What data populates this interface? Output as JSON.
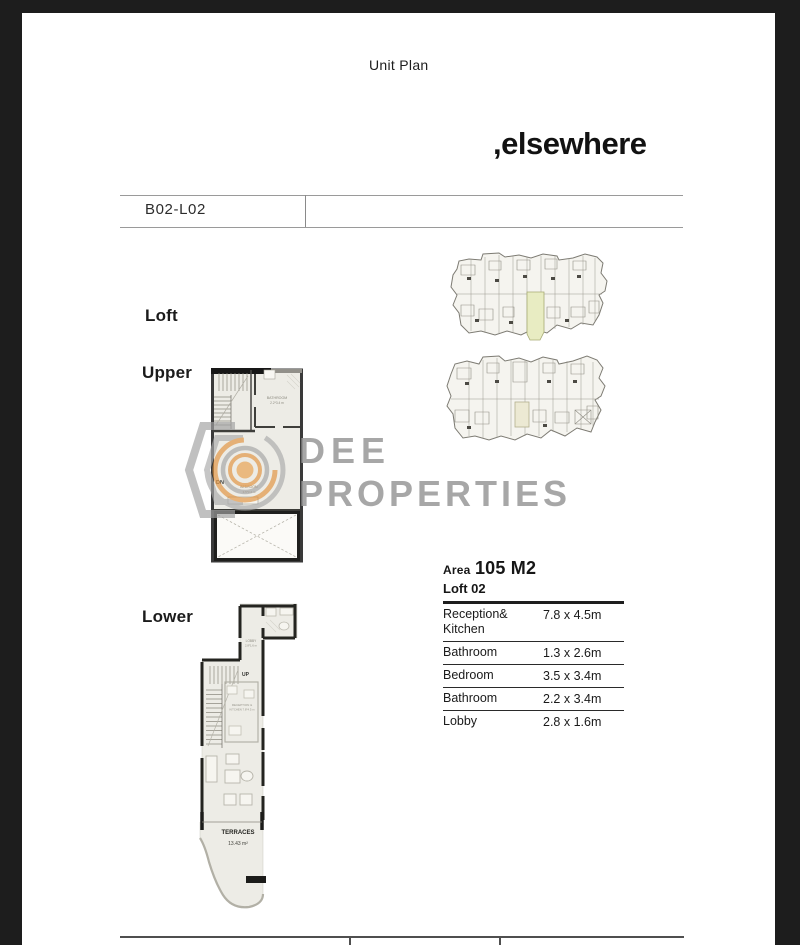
{
  "page": {
    "title": "Unit Plan"
  },
  "brand": {
    "wordmark": ",elsewhere"
  },
  "header": {
    "unit_code": "B02-L02"
  },
  "section_labels": {
    "loft": "Loft",
    "upper": "Upper",
    "lower": "Lower"
  },
  "watermark": {
    "line1": "DEE",
    "line2": "PROPERTIES"
  },
  "upper_plan": {
    "bathroom_label": "BATHROOM",
    "bathroom_dims": "2.2*3.4 m",
    "dn_label": "DN",
    "bedroom_label": "BEDROOM",
    "bedroom_dims": "3.5*3.4 m"
  },
  "lower_plan": {
    "lobby_label": "LOBBY",
    "lobby_dims": "2.8*1.6 m",
    "up_label": "UP",
    "reception_line1": "RECEPTION &",
    "reception_line2": "KITCHEN 7.8*4.5 m",
    "terrace_label": "TERRACES",
    "terrace_area": "13.43 m²"
  },
  "area_table": {
    "area_label": "Area",
    "area_value": "105 M2",
    "unit_label": "Loft 02",
    "rows": [
      {
        "name": "Reception& Kitchen",
        "dims": "7.8 x 4.5m"
      },
      {
        "name": "Bathroom",
        "dims": "1.3 x 2.6m"
      },
      {
        "name": "Bedroom",
        "dims": "3.5 x 3.4m"
      },
      {
        "name": "Bathroom",
        "dims": "2.2 x 3.4m"
      },
      {
        "name": "Lobby",
        "dims": "2.8 x 1.6m"
      }
    ]
  },
  "colors": {
    "frame": "#1d1d1d",
    "plan_fill": "#edece6",
    "wall": "#242420",
    "highlight_unit": "#e8ecc2",
    "watermark_gray": "#9c9c9c",
    "watermark_orange": "#e29440"
  }
}
